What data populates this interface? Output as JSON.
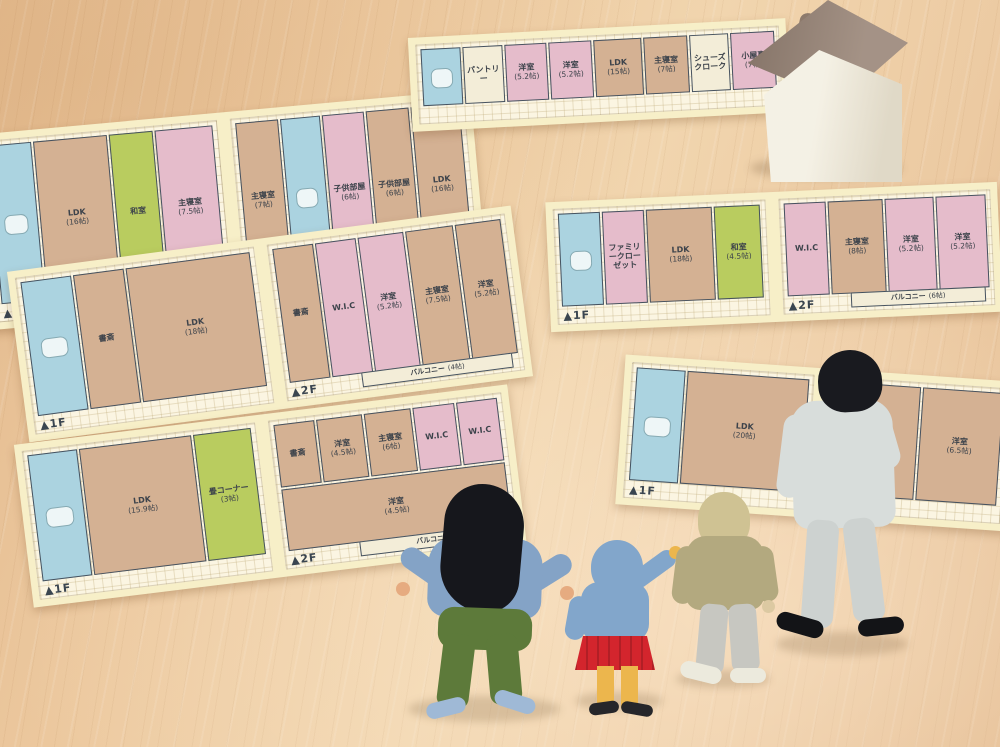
{
  "scene": {
    "description": "Miniature family figures (mother, daughter, son, father) standing on a wooden table viewing paper house floor plans, with a small ceramic house model in the top right",
    "floor_area_unit": "帖"
  },
  "colors": {
    "wood": "#ecc89e",
    "paper": "#f7efc8",
    "plan_bg": "#fbf5e2",
    "wall": "#46525f",
    "tan": "#d4b193",
    "pink": "#e5bccb",
    "blue": "#abd3e0",
    "green": "#b9cc5f",
    "balcony_fill": "#f3edd8"
  },
  "plans": [
    {
      "id": "top-left",
      "panels": [
        {
          "marker": "▲1F",
          "rooms": [
            {
              "label": "",
              "size": "",
              "color": "blue"
            },
            {
              "label": "LDK",
              "size": "(16帖)",
              "color": "tan"
            },
            {
              "label": "和室",
              "size": "",
              "color": "green"
            },
            {
              "label": "主寝室",
              "size": "(7.5帖)",
              "color": "pink"
            }
          ]
        },
        {
          "marker": "▲2F",
          "rooms": [
            {
              "label": "主寝室",
              "size": "(7帖)",
              "color": "tan"
            },
            {
              "label": "",
              "size": "",
              "color": "blue"
            },
            {
              "label": "子供部屋",
              "size": "(6帖)",
              "color": "pink"
            },
            {
              "label": "子供部屋",
              "size": "(6帖)",
              "color": "tan"
            },
            {
              "label": "LDK",
              "size": "(16帖)",
              "color": "tan"
            },
            {
              "label": "バルコニー",
              "size": "",
              "color": "balcony_fill"
            }
          ]
        }
      ]
    },
    {
      "id": "top-middle",
      "panels": [
        {
          "marker": "",
          "rooms": [
            {
              "label": "",
              "size": "",
              "color": "blue"
            },
            {
              "label": "パントリー",
              "size": "",
              "color": "balcony_fill"
            },
            {
              "label": "洋室",
              "size": "(5.2帖)",
              "color": "pink"
            },
            {
              "label": "洋室",
              "size": "(5.2帖)",
              "color": "pink"
            },
            {
              "label": "LDK",
              "size": "(15帖)",
              "color": "tan"
            },
            {
              "label": "主寝室",
              "size": "(7帖)",
              "color": "tan"
            },
            {
              "label": "シューズクローク",
              "size": "",
              "color": "balcony_fill"
            },
            {
              "label": "小屋裏",
              "size": "(7帖)",
              "color": "pink"
            }
          ]
        }
      ]
    },
    {
      "id": "middle-left",
      "panels": [
        {
          "marker": "▲1F",
          "rooms": [
            {
              "label": "",
              "size": "",
              "color": "blue"
            },
            {
              "label": "書斎",
              "size": "",
              "color": "tan"
            },
            {
              "label": "LDK",
              "size": "(18帖)",
              "color": "tan"
            }
          ]
        },
        {
          "marker": "▲2F",
          "rooms": [
            {
              "label": "書斎",
              "size": "",
              "color": "tan"
            },
            {
              "label": "W.I.C",
              "size": "",
              "color": "pink"
            },
            {
              "label": "洋室",
              "size": "(5.2帖)",
              "color": "pink"
            },
            {
              "label": "主寝室",
              "size": "(7.5帖)",
              "color": "tan"
            },
            {
              "label": "洋室",
              "size": "(5.2帖)",
              "color": "tan"
            },
            {
              "label": "バルコニー",
              "size": "(4帖)",
              "color": "balcony_fill"
            }
          ]
        }
      ]
    },
    {
      "id": "middle-right",
      "panels": [
        {
          "marker": "▲1F",
          "rooms": [
            {
              "label": "",
              "size": "",
              "color": "blue"
            },
            {
              "label": "ファミリークローゼット",
              "size": "",
              "color": "pink"
            },
            {
              "label": "LDK",
              "size": "(18帖)",
              "color": "tan"
            },
            {
              "label": "和室",
              "size": "(4.5帖)",
              "color": "green"
            }
          ]
        },
        {
          "marker": "▲2F",
          "rooms": [
            {
              "label": "W.I.C",
              "size": "",
              "color": "pink"
            },
            {
              "label": "主寝室",
              "size": "(8帖)",
              "color": "tan"
            },
            {
              "label": "洋室",
              "size": "(5.2帖)",
              "color": "pink"
            },
            {
              "label": "洋室",
              "size": "(5.2帖)",
              "color": "pink"
            },
            {
              "label": "バルコニー",
              "size": "(6帖)",
              "color": "balcony_fill"
            }
          ]
        }
      ]
    },
    {
      "id": "bottom-left",
      "panels": [
        {
          "marker": "▲1F",
          "rooms": [
            {
              "label": "",
              "size": "",
              "color": "blue"
            },
            {
              "label": "LDK",
              "size": "(15.9帖)",
              "color": "tan"
            },
            {
              "label": "畳コーナー",
              "size": "(3帖)",
              "color": "green"
            }
          ]
        },
        {
          "marker": "▲2F",
          "rooms": [
            {
              "label": "書斎",
              "size": "",
              "color": "tan"
            },
            {
              "label": "洋室",
              "size": "(4.5帖)",
              "color": "tan"
            },
            {
              "label": "主寝室",
              "size": "(6帖)",
              "color": "tan"
            },
            {
              "label": "W.I.C",
              "size": "",
              "color": "pink"
            },
            {
              "label": "W.I.C",
              "size": "",
              "color": "pink"
            },
            {
              "label": "洋室",
              "size": "(4.5帖)",
              "color": "tan"
            },
            {
              "label": "バルコニー",
              "size": "",
              "color": "balcony_fill"
            }
          ]
        }
      ]
    },
    {
      "id": "bottom-right",
      "panels": [
        {
          "marker": "▲1F",
          "rooms": [
            {
              "label": "",
              "size": "",
              "color": "blue"
            },
            {
              "label": "LDK",
              "size": "(20帖)",
              "color": "tan"
            }
          ]
        },
        {
          "marker": "▲2F",
          "rooms": [
            {
              "label": "主寝室",
              "size": "(8帖)",
              "color": "tan"
            },
            {
              "label": "洋室",
              "size": "(6.5帖)",
              "color": "tan"
            }
          ]
        }
      ]
    }
  ],
  "house_model": {
    "colors": {
      "body": "#f1ecdc",
      "roof": "#9a8678",
      "chimney": "#8d7a6c"
    }
  },
  "figures": [
    {
      "role": "mother",
      "colors": {
        "hair": "#16171c",
        "top": "#84a3c6",
        "bottom": "#5d7a3a",
        "shoes": "#9fb9d6",
        "skin": "#e6ab80"
      }
    },
    {
      "role": "daughter",
      "colors": {
        "hair": "#82a6cb",
        "top": "#82a6cb",
        "bottom": "#d3252d",
        "legs": "#ecb64d",
        "shoes": "#26262a",
        "skin": "#ecb64d"
      }
    },
    {
      "role": "son",
      "colors": {
        "hair": "#cfc293",
        "top": "#b3a97f",
        "bottom": "#c7c7c1",
        "shoes": "#eceadd",
        "skin": "#dcc9a2"
      }
    },
    {
      "role": "father",
      "colors": {
        "hair": "#191a1f",
        "top": "#d8dddb",
        "forearm": "#c9d0ce",
        "bottom": "#cdd2d0",
        "shoes": "#131417",
        "skin": "#e6ab80"
      }
    }
  ]
}
